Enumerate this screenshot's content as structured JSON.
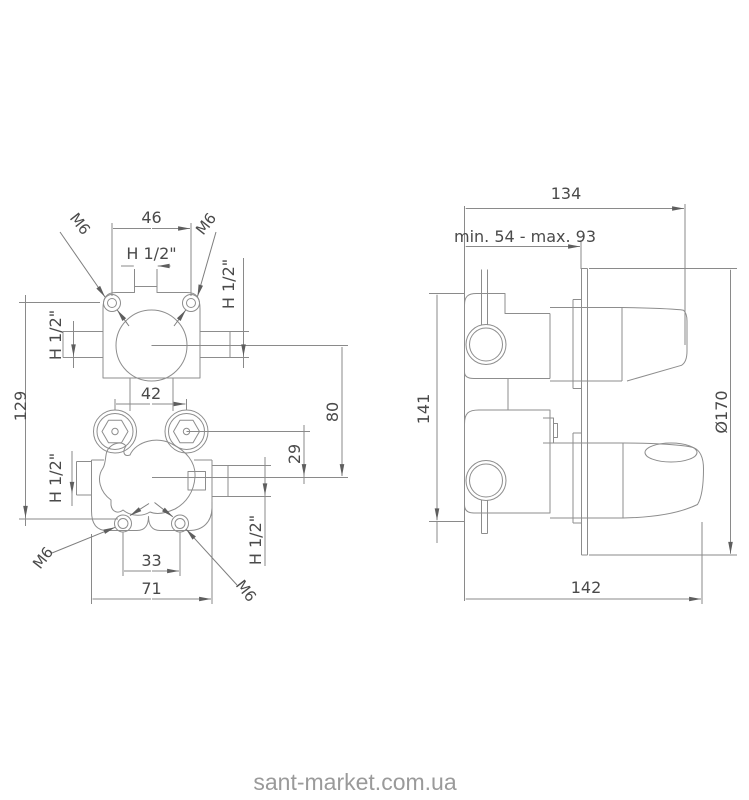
{
  "front_view": {
    "dim_mount_hole_spacing": "46",
    "dim_top_inlet_thread": "H 1/2\"",
    "label_mount_thread_top_left": "M6",
    "label_mount_thread_top_right": "M6",
    "dim_side_port_upper_left": "H 1/2\"",
    "dim_side_port_upper_right": "H 1/2\"",
    "dim_overall_height": "129",
    "dim_hex_union_spacing": "42",
    "dim_valve_center_distance": "80",
    "dim_hex_to_center": "29",
    "dim_lower_hole_spacing": "33",
    "dim_body_width": "71",
    "dim_side_port_lower_left": "H 1/2\"",
    "dim_side_port_lower_right": "H 1/2\"",
    "label_mount_thread_bottom_left": "M6",
    "label_mount_thread_bottom_right": "M6"
  },
  "side_view": {
    "dim_overall_depth": "134",
    "dim_installation_depth": "min. 54 - max. 93",
    "dim_body_height": "141",
    "dim_plate_diameter": "Ø170",
    "dim_overall_width": "142"
  },
  "watermark": "sant-market.com.ua",
  "colors": {
    "line": "#8d8d8d",
    "arrow": "#5e5e5e",
    "text": "#4a4a4a",
    "watermark": "#9a9a9a",
    "background": "#ffffff"
  }
}
